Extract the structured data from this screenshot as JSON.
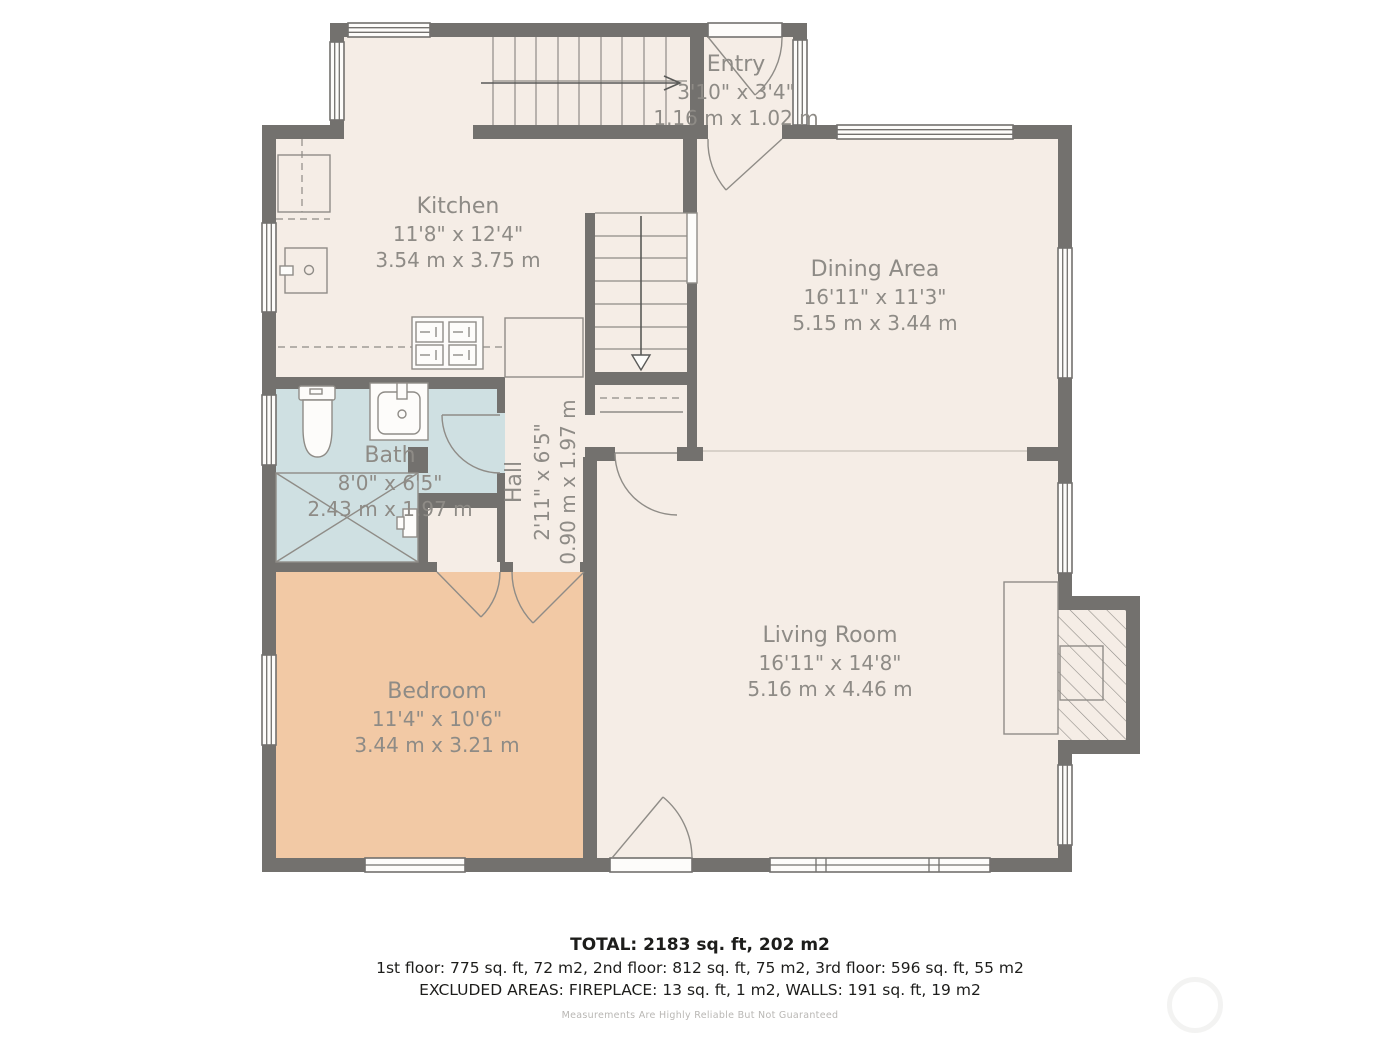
{
  "colors": {
    "wall": "#73716e",
    "floor": "#f5ede6",
    "bath-floor": "#cfe0e2",
    "bedroom-floor": "#f2c9a5",
    "line": "#8f8c87",
    "label": "#8e8b86",
    "open-line": "#d8d1c9",
    "window": "#fdfcfa",
    "text-dark": "#1d1d1b",
    "text-faint": "#b9b7b4",
    "watermark": "#f3f3f2"
  },
  "rooms": [
    {
      "name": "Entry",
      "imperial": "3'10\" x 3'4\"",
      "metric": "1.16 m x 1.02 m"
    },
    {
      "name": "Kitchen",
      "imperial": "11'8\" x 12'4\"",
      "metric": "3.54 m x 3.75 m"
    },
    {
      "name": "Dining Area",
      "imperial": "16'11\" x 11'3\"",
      "metric": "5.15 m x 3.44 m"
    },
    {
      "name": "Bath",
      "imperial": "8'0\" x 6'5\"",
      "metric": "2.43 m x 1.97 m"
    },
    {
      "name": "Hall",
      "imperial": "2'11\" x 6'5\"",
      "metric": "0.90 m x 1.97 m"
    },
    {
      "name": "Bedroom",
      "imperial": "11'4\" x 10'6\"",
      "metric": "3.44 m x 3.21 m"
    },
    {
      "name": "Living Room",
      "imperial": "16'11\" x 14'8\"",
      "metric": "5.16 m x 4.46 m"
    }
  ],
  "summary": {
    "total": "TOTAL: 2183 sq. ft, 202 m2",
    "floors": "1st floor: 775 sq. ft, 72 m2, 2nd floor: 812 sq. ft, 75 m2, 3rd floor: 596 sq. ft, 55 m2",
    "excluded": "EXCLUDED AREAS: FIREPLACE: 13 sq. ft, 1 m2, WALLS: 191 sq. ft, 19 m2",
    "disclaimer": "Measurements Are Highly Reliable But Not Guaranteed"
  }
}
